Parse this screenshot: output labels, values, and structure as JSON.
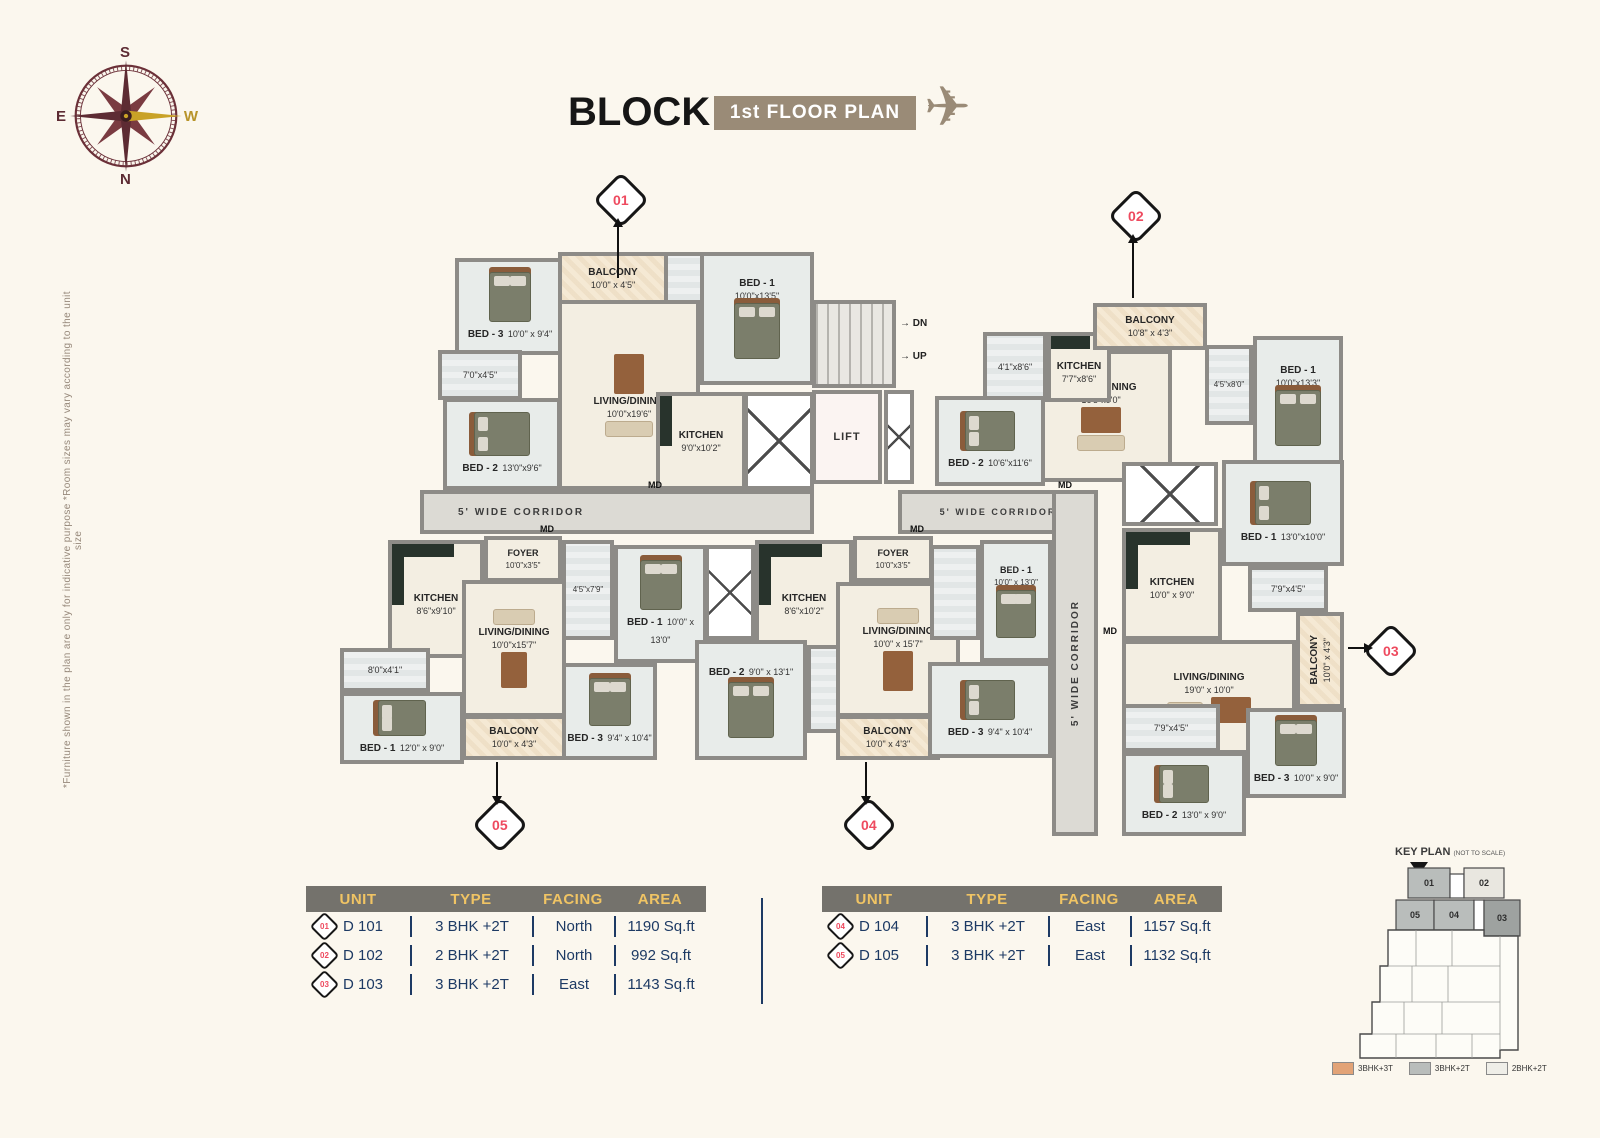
{
  "header": {
    "block_title": "BLOCK D",
    "floor_badge": "1st FLOOR PLAN",
    "badge_color": "#9a8b77"
  },
  "compass": {
    "top": "S",
    "bottom": "N",
    "left": "E",
    "right": "W"
  },
  "disclaimer": "*Furniture shown in the plan are only for indicative purpose *Room sizes may vary according to the unit size",
  "floor_plan": {
    "corridor_labels": [
      "5' WIDE CORRIDOR",
      "5' WIDE CORRIDOR",
      "5' WIDE CORRIDOR"
    ],
    "core": {
      "lift": "LIFT",
      "down": "DN",
      "up": "UP",
      "arrow": "→"
    },
    "md_label": "MD",
    "markers": [
      "01",
      "02",
      "03",
      "04",
      "05"
    ],
    "units": [
      {
        "id": "D 101",
        "rooms": [
          {
            "name": "BED - 3",
            "dims": "10'0\" x 9'4\""
          },
          {
            "name": "BALCONY",
            "dims": "10'0\" x 4'5\""
          },
          {
            "name": "BED - 1",
            "dims": "10'0\"x13'5\""
          },
          {
            "name": "",
            "dims": "7'0\"x4'5\""
          },
          {
            "name": "LIVING/DINING",
            "dims": "10'0\"x19'6\""
          },
          {
            "name": "BED - 2",
            "dims": "13'0\"x9'6\""
          },
          {
            "name": "KITCHEN",
            "dims": "9'0\"x10'2\""
          }
        ]
      },
      {
        "id": "D 102",
        "rooms": [
          {
            "name": "",
            "dims": "4'1\"x8'6\""
          },
          {
            "name": "KITCHEN",
            "dims": "7'7\"x8'6\""
          },
          {
            "name": "BALCONY",
            "dims": "10'8\" x 4'3\""
          },
          {
            "name": "LIVING/DINING",
            "dims": "16'5\"x9'0\""
          },
          {
            "name": "BED - 2",
            "dims": "10'6\"x11'6\""
          },
          {
            "name": "",
            "dims": "4'5\"x8'0\""
          },
          {
            "name": "BED - 1",
            "dims": "10'0\"x13'3\""
          }
        ]
      },
      {
        "id": "D 103",
        "rooms": [
          {
            "name": "KITCHEN",
            "dims": "10'0\" x 9'0\""
          },
          {
            "name": "BED - 1",
            "dims": "13'0\"x10'0\""
          },
          {
            "name": "",
            "dims": "7'9\"x4'5\""
          },
          {
            "name": "LIVING/DINING",
            "dims": "19'0\" x 10'0\""
          },
          {
            "name": "BALCONY",
            "dims": "10'0\" x 4'3\""
          },
          {
            "name": "",
            "dims": "7'9\"x4'5\""
          },
          {
            "name": "BED - 3",
            "dims": "10'0\" x 9'0\""
          },
          {
            "name": "BED - 2",
            "dims": "13'0\" x 9'0\""
          }
        ]
      },
      {
        "id": "D 104",
        "rooms": [
          {
            "name": "FOYER",
            "dims": "10'0\"x3'5\""
          },
          {
            "name": "KITCHEN",
            "dims": "8'6\"x10'2\""
          },
          {
            "name": "BED - 2",
            "dims": "9'0\" x 13'1\""
          },
          {
            "name": "LIVING/DINING",
            "dims": "10'0\" x 15'7\""
          },
          {
            "name": "BALCONY",
            "dims": "10'0\" x 4'3\""
          },
          {
            "name": "BED - 1",
            "dims": "10'0\" x 13'0\""
          },
          {
            "name": "BED - 3",
            "dims": "9'4\" x 10'4\""
          }
        ]
      },
      {
        "id": "D 105",
        "rooms": [
          {
            "name": "FOYER",
            "dims": "10'0\"x3'5\""
          },
          {
            "name": "KITCHEN",
            "dims": "8'6\"x9'10\""
          },
          {
            "name": "",
            "dims": "8'0\"x4'1\""
          },
          {
            "name": "BED - 1",
            "dims": "12'0\" x 9'0\""
          },
          {
            "name": "LIVING/DINING",
            "dims": "10'0\"x15'7\""
          },
          {
            "name": "BALCONY",
            "dims": "10'0\" x 4'3\""
          },
          {
            "name": "",
            "dims": "4'5\"x7'9\""
          },
          {
            "name": "BED - 1",
            "dims": "10'0\" x 13'0\""
          },
          {
            "name": "BED - 3",
            "dims": "9'4\" x 10'4\""
          }
        ]
      }
    ]
  },
  "tables": [
    {
      "headers": [
        "UNIT",
        "TYPE",
        "FACING",
        "AREA"
      ],
      "rows": [
        {
          "badge": "01",
          "unit": "D 101",
          "type": "3 BHK +2T",
          "facing": "North",
          "area": "1190 Sq.ft"
        },
        {
          "badge": "02",
          "unit": "D 102",
          "type": "2 BHK +2T",
          "facing": "North",
          "area": "992 Sq.ft"
        },
        {
          "badge": "03",
          "unit": "D 103",
          "type": "3 BHK +2T",
          "facing": "East",
          "area": "1143 Sq.ft"
        }
      ]
    },
    {
      "headers": [
        "UNIT",
        "TYPE",
        "FACING",
        "AREA"
      ],
      "rows": [
        {
          "badge": "04",
          "unit": "D 104",
          "type": "3 BHK +2T",
          "facing": "East",
          "area": "1157 Sq.ft"
        },
        {
          "badge": "05",
          "unit": "D 105",
          "type": "3 BHK +2T",
          "facing": "East",
          "area": "1132 Sq.ft"
        }
      ]
    }
  ],
  "key_plan": {
    "title": "KEY PLAN",
    "subtitle": "(NOT TO SCALE)",
    "north_label": "N",
    "unit_labels": [
      "01",
      "02",
      "05",
      "04",
      "03"
    ],
    "legend": [
      {
        "label": "3BHK+3T",
        "color": "#e2a377"
      },
      {
        "label": "3BHK+2T",
        "color": "#b9bdbb"
      },
      {
        "label": "2BHK+2T",
        "color": "#efeee8"
      }
    ]
  },
  "colors": {
    "table_header_bg": "#74726c",
    "table_header_text": "#f0c464",
    "table_text": "#1d3a64",
    "marker_red": "#ee4a5f",
    "wall": "#8d8b87",
    "badge_taupe": "#9a8b77",
    "background": "#fbf7ee"
  }
}
